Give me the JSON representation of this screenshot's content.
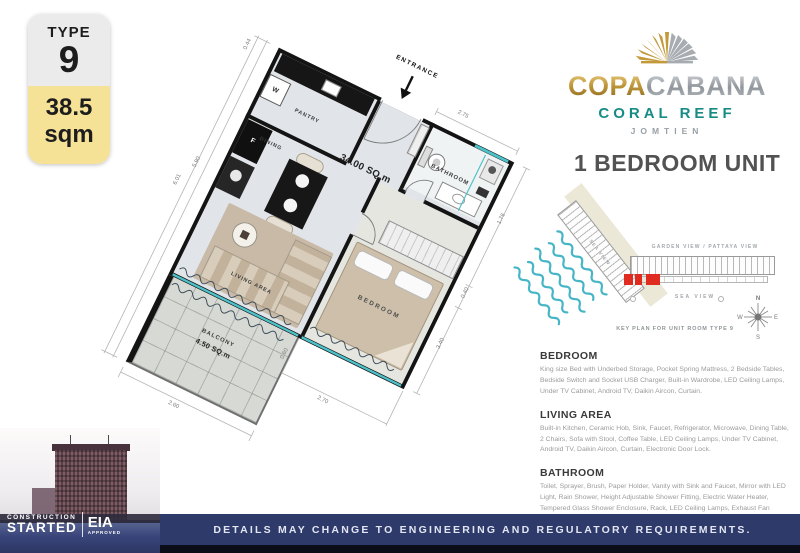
{
  "badge": {
    "type_label": "TYPE",
    "type_number": "9",
    "area_value": "38.5",
    "area_unit": "sqm"
  },
  "logo": {
    "brand_gold": "COPA",
    "brand_silver": "CABANA",
    "series": "CORAL REEF",
    "location": "JOMTIEN"
  },
  "unit": {
    "title": "1 BEDROOM UNIT"
  },
  "floorplan": {
    "labels": {
      "entrance": "ENTRANCE",
      "pantry": "PANTRY",
      "dining": "DINING",
      "bathroom": "BATHROOM",
      "bedroom": "BEDROOM",
      "living": "LIVING AREA",
      "balcony": "BALCONY",
      "unit_area": "34.00 SQ.m",
      "balcony_area": "4.50 SQ.m",
      "washer": "W",
      "fridge": "F"
    },
    "dims": {
      "top_left": "0.44",
      "left_outer": "6.01",
      "left_inner": "5.90",
      "top_right": "2.75",
      "right_upper": "1.76",
      "right_mid": "0.40",
      "right_lower": "3.40",
      "bottom": "2.70",
      "bottom_inner": "0.60",
      "balcony": "2.60"
    }
  },
  "keyplan": {
    "label_garden": "GARDEN VIEW / PATTAYA VIEW",
    "label_sea": "SEA VIEW",
    "label_diagonal": "SEA VIEW",
    "caption": "KEY PLAN FOR UNIT ROOM TYPE 9",
    "compass": {
      "n": "N",
      "e": "E",
      "s": "S",
      "w": "W"
    }
  },
  "sections": [
    {
      "title": "BEDROOM",
      "body": "King size Bed with Underbed Storage, Pocket Spring Mattress, 2 Bedside Tables, Bedside Switch and Socket USB Charger, Built-in Wardrobe, LED Ceiling Lamps, Under TV Cabinet, Android TV, Daikin Aircon, Curtain."
    },
    {
      "title": "LIVING AREA",
      "body": "Built-in Kitchen, Ceramic Hob, Sink, Faucet, Refrigerator, Microwave, Dining Table, 2 Chairs, Sofa with Stool, Coffee Table, LED Ceiling Lamps, Under TV Cabinet, Android TV, Daikin Aircon, Curtain, Electronic Door Lock."
    },
    {
      "title": "BATHROOM",
      "body": "Toilet, Sprayer, Brush, Paper Holder, Vanity with Sink and Faucet, Mirror with LED Light, Rain Shower, Height Adjustable Shower Fitting, Electric Water Heater, Tempered Glass Shower Enclosure, Rack, LED Ceiling Lamps, Exhaust Fan"
    }
  ],
  "footer": {
    "disclaimer": "DETAILS MAY CHANGE TO ENGINEERING AND REGULATORY REQUIREMENTS."
  },
  "construction": {
    "line1": "CONSTRUCTION",
    "line2": "STARTED",
    "eia": "EIA",
    "eia_sub": "APPROVED"
  },
  "colors": {
    "accent_teal": "#178c85",
    "window_teal": "#4ec0c8",
    "gold": "#c29a3c",
    "navy_bar": "#2e3a6a",
    "highlight_red": "#e02b20",
    "badge_yellow": "#f6e296"
  }
}
